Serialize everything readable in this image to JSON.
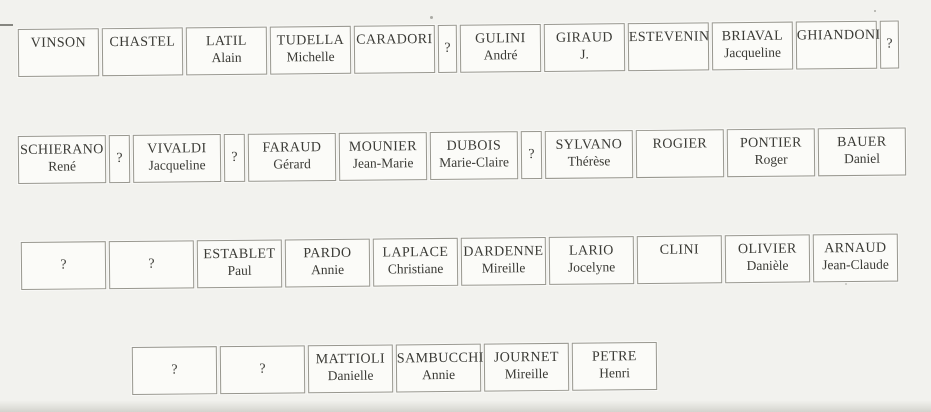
{
  "document": {
    "type": "scanned name-label sheet",
    "unknown_label": "?"
  },
  "colors": {
    "background": "#f2f2ee",
    "box_fill": "#fbfbf8",
    "border": "#98978f",
    "text": "#3a3a35"
  },
  "rows": [
    {
      "items": [
        {
          "surname": "VINSON",
          "firstname": ""
        },
        {
          "surname": "CHASTEL",
          "firstname": ""
        },
        {
          "surname": "LATIL",
          "firstname": "Alain"
        },
        {
          "surname": "TUDELLA",
          "firstname": "Michelle"
        },
        {
          "surname": "CARADORI",
          "firstname": ""
        },
        {
          "unknown": true,
          "narrow": true,
          "label": "?"
        },
        {
          "surname": "GULINI",
          "firstname": "André"
        },
        {
          "surname": "GIRAUD",
          "firstname": "J."
        },
        {
          "surname": "ESTEVENIN",
          "firstname": ""
        },
        {
          "surname": "BRIAVAL",
          "firstname": "Jacqueline"
        },
        {
          "surname": "GHIANDONI",
          "firstname": ""
        },
        {
          "unknown": true,
          "narrow": true,
          "label": "?"
        }
      ]
    },
    {
      "items": [
        {
          "surname": "SCHIERANO",
          "firstname": "René"
        },
        {
          "unknown": true,
          "narrow": true,
          "label": "?"
        },
        {
          "surname": "VIVALDI",
          "firstname": "Jacqueline"
        },
        {
          "unknown": true,
          "narrow": true,
          "label": "?"
        },
        {
          "surname": "FARAUD",
          "firstname": "Gérard"
        },
        {
          "surname": "MOUNIER",
          "firstname": "Jean-Marie"
        },
        {
          "surname": "DUBOIS",
          "firstname": "Marie-Claire"
        },
        {
          "unknown": true,
          "narrow": true,
          "label": "?"
        },
        {
          "surname": "SYLVANO",
          "firstname": "Thérèse"
        },
        {
          "surname": "ROGIER",
          "firstname": ""
        },
        {
          "surname": "PONTIER",
          "firstname": "Roger"
        },
        {
          "surname": "BAUER",
          "firstname": "Daniel"
        }
      ]
    },
    {
      "items": [
        {
          "unknown": true,
          "narrow": false,
          "label": "?"
        },
        {
          "unknown": true,
          "narrow": false,
          "label": "?"
        },
        {
          "surname": "ESTABLET",
          "firstname": "Paul"
        },
        {
          "surname": "PARDO",
          "firstname": "Annie"
        },
        {
          "surname": "LAPLACE",
          "firstname": "Christiane"
        },
        {
          "surname": "DARDENNE",
          "firstname": "Mireille"
        },
        {
          "surname": "LARIO",
          "firstname": "Jocelyne"
        },
        {
          "surname": "CLINI",
          "firstname": ""
        },
        {
          "surname": "OLIVIER",
          "firstname": "Danièle"
        },
        {
          "surname": "ARNAUD",
          "firstname": "Jean-Claude"
        }
      ]
    },
    {
      "items": [
        {
          "unknown": true,
          "narrow": false,
          "label": "?"
        },
        {
          "unknown": true,
          "narrow": false,
          "label": "?"
        },
        {
          "surname": "MATTIOLI",
          "firstname": "Danielle"
        },
        {
          "surname": "SAMBUCCHI",
          "firstname": "Annie"
        },
        {
          "surname": "JOURNET",
          "firstname": "Mireille"
        },
        {
          "surname": "PETRE",
          "firstname": "Henri"
        }
      ]
    }
  ]
}
